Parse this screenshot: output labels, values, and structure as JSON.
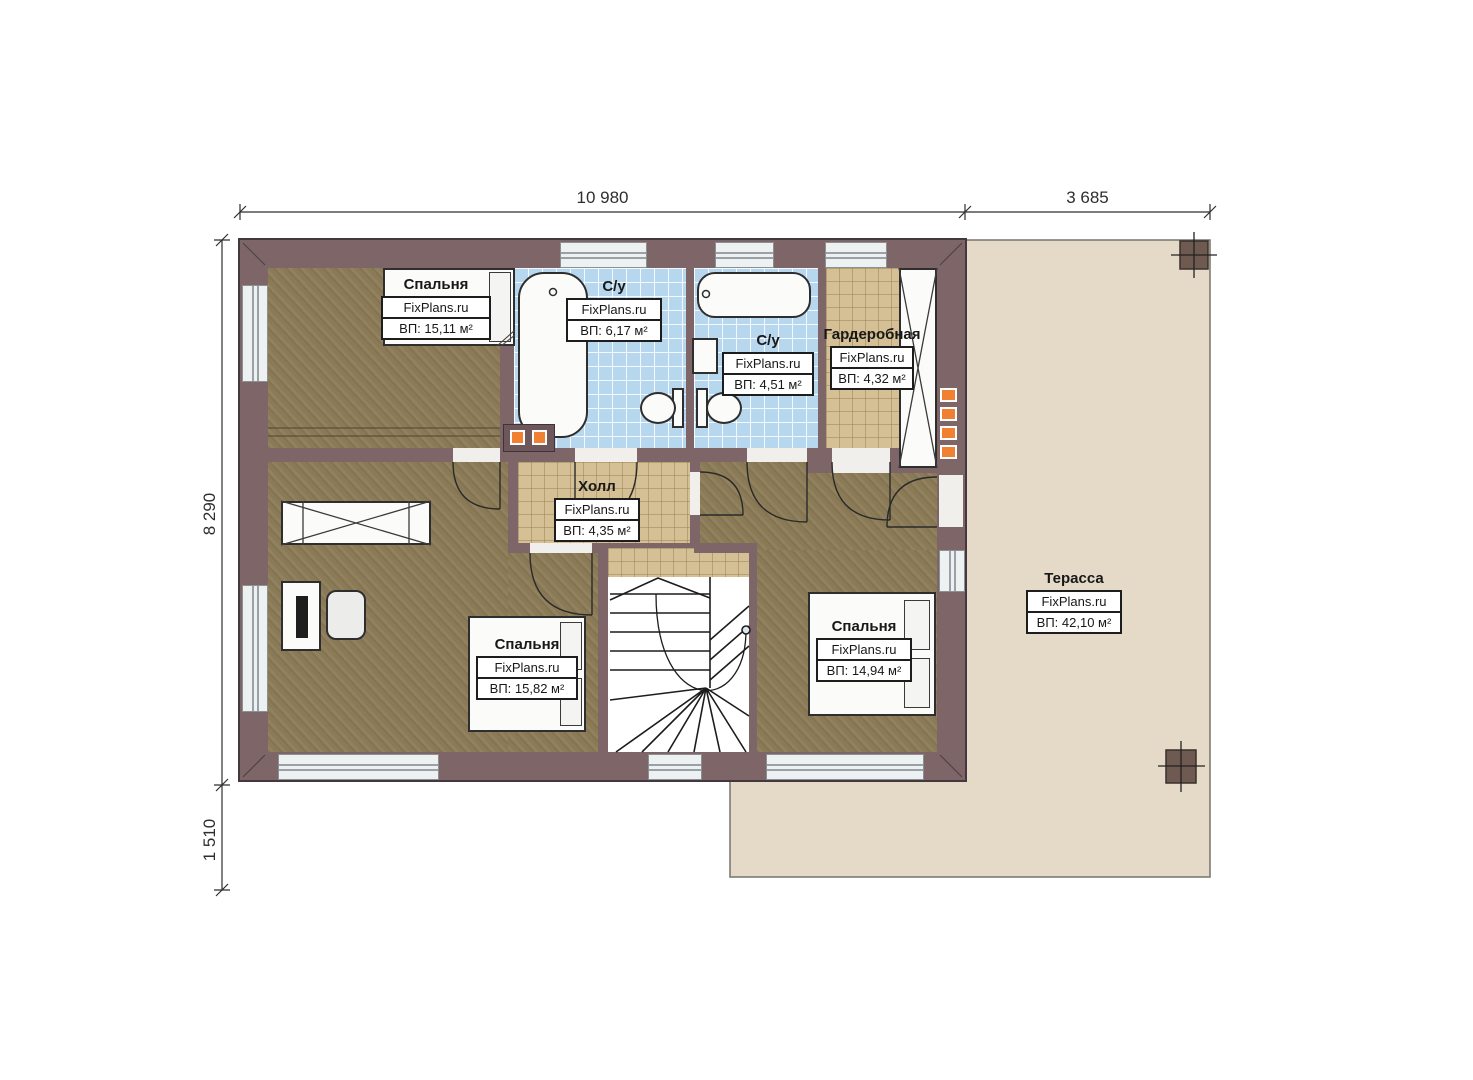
{
  "plan": {
    "type": "floor-plan",
    "brand": "FixPlans.ru",
    "accent_colors": {
      "wall": "#7d6568",
      "bedroom_floor": "#8b7a56",
      "bathroom_tile": "#b7d7ef",
      "hall_tile": "#d5c095",
      "terrace": "#e4dac7",
      "orange_marker": "#f08032"
    }
  },
  "dimensions": {
    "top_width": "10 980",
    "terrace_width": "3 685",
    "side_height": "8 290",
    "terrace_side": "1 510"
  },
  "rooms": [
    {
      "id": "bedroom-top-left",
      "name": "Спальня",
      "brand": "FixPlans.ru",
      "area": "ВП: 15,11 м²"
    },
    {
      "id": "bathroom-1",
      "name": "С/у",
      "brand": "FixPlans.ru",
      "area": "ВП: 6,17 м²"
    },
    {
      "id": "bathroom-2",
      "name": "С/у",
      "brand": "FixPlans.ru",
      "area": "ВП: 4,51 м²"
    },
    {
      "id": "wardrobe",
      "name": "Гардеробная",
      "brand": "FixPlans.ru",
      "area": "ВП: 4,32 м²"
    },
    {
      "id": "hall",
      "name": "Холл",
      "brand": "FixPlans.ru",
      "area": "ВП: 4,35 м²"
    },
    {
      "id": "bedroom-bottom-left",
      "name": "Спальня",
      "brand": "FixPlans.ru",
      "area": "ВП: 15,82 м²"
    },
    {
      "id": "bedroom-bottom-right",
      "name": "Спальня",
      "brand": "FixPlans.ru",
      "area": "ВП: 14,94 м²"
    },
    {
      "id": "terrace",
      "name": "Терасса",
      "brand": "FixPlans.ru",
      "area": "ВП: 42,10 м²"
    }
  ]
}
